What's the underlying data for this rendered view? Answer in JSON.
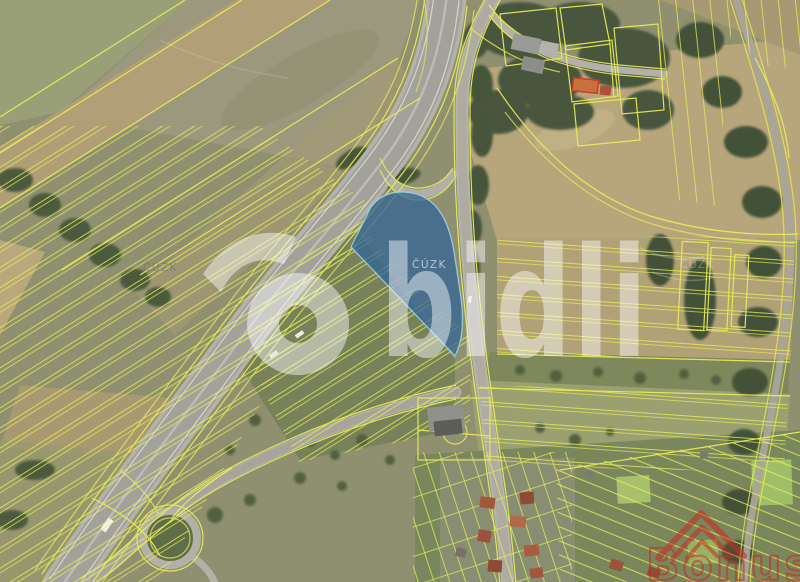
{
  "map": {
    "watermarks": {
      "brand_center": "bidli",
      "cuzk_label": "ČÚZK",
      "agency_bottom_right": "Bonus"
    },
    "colors": {
      "cadastral_line": "#e9ef55",
      "selected_parcel_fill": "#2e6298",
      "selected_parcel_edge": "#9fd4e8",
      "brand_watermark": "#ffffff",
      "agency_watermark": "#c92c22"
    }
  }
}
